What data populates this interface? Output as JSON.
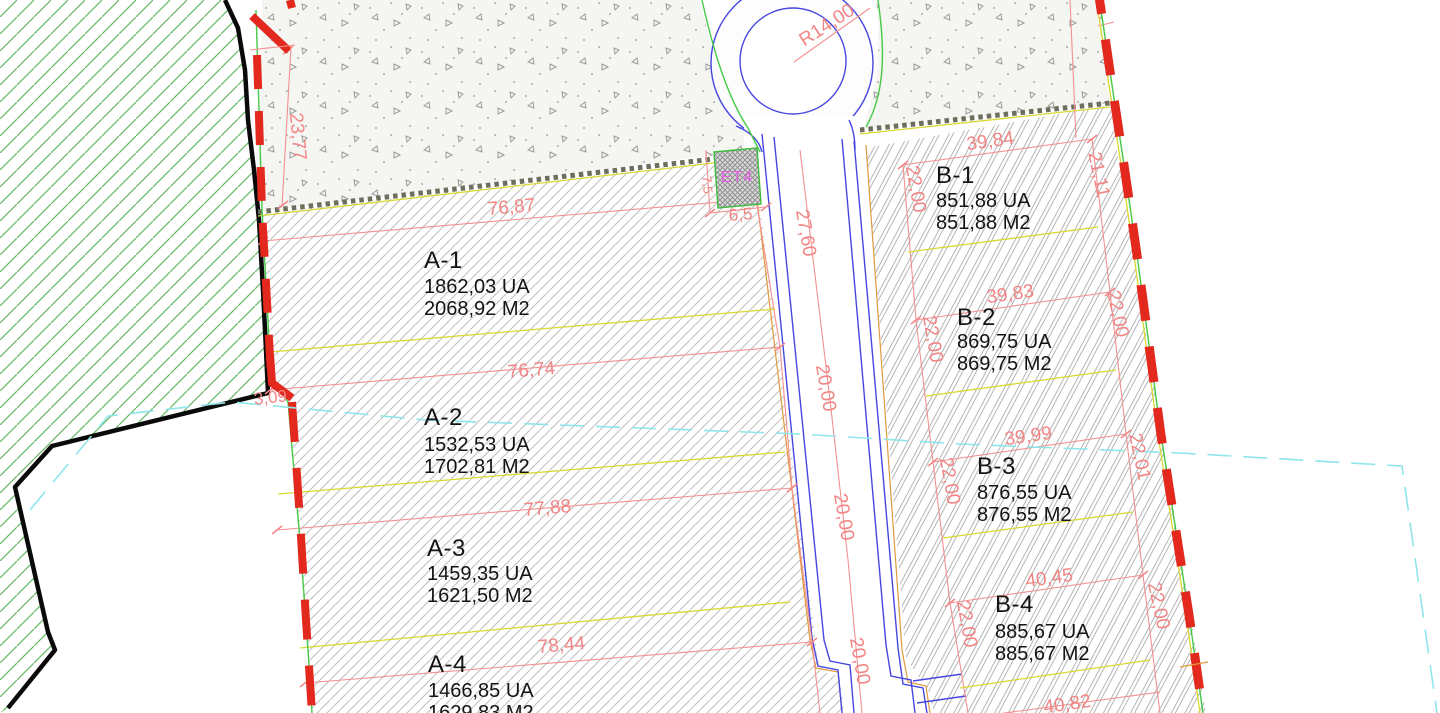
{
  "parcels": {
    "a": [
      {
        "name": "A-1",
        "area_ua": "1862,03 UA",
        "area_m2": "2068,92 M2"
      },
      {
        "name": "A-2",
        "area_ua": "1532,53 UA",
        "area_m2": "1702,81 M2"
      },
      {
        "name": "A-3",
        "area_ua": "1459,35 UA",
        "area_m2": "1621,50 M2"
      },
      {
        "name": "A-4",
        "area_ua": "1466,85 UA",
        "area_m2": "1629,83 M2"
      }
    ],
    "b": [
      {
        "name": "B-1",
        "area_ua": "851,88 UA",
        "area_m2": "851,88 M2"
      },
      {
        "name": "B-2",
        "area_ua": "869,75 UA",
        "area_m2": "869,75 M2"
      },
      {
        "name": "B-3",
        "area_ua": "876,55 UA",
        "area_m2": "876,55 M2"
      },
      {
        "name": "B-4",
        "area_ua": "885,67 UA",
        "area_m2": "885,67 M2"
      }
    ]
  },
  "dimensions": {
    "a_widths": [
      "76,87",
      "76,74",
      "77,88",
      "78,44"
    ],
    "b_widths": [
      "39,84",
      "39,83",
      "39,99",
      "40,45",
      "40,82"
    ],
    "b_left_depths": [
      "22,00",
      "22,00",
      "22,00",
      "22,00"
    ],
    "b_right_depths": [
      "21,11",
      "22,00",
      "22,01",
      "22,00"
    ],
    "road_radius": "R14,00",
    "road_width_top": "27,60",
    "road_segments": [
      "20,00",
      "20,00",
      "20,00"
    ],
    "left_boundary_length": "23,77",
    "left_boundary_offset": "3,09",
    "transformer_width": "6,5",
    "transformer_depth": "7,5"
  },
  "labels": {
    "transformer": "ET4"
  },
  "colors": {
    "dimension_red": "#f28585",
    "boundary_red": "#e3281e",
    "road_blue": "#4747e0",
    "utility_green": "#46c946",
    "utility_yellow": "#d8d832",
    "overlay_cyan": "#8fe6ea",
    "transformer_magenta": "#e65ce6",
    "hatch_gray": "#b9b9b9",
    "text_black": "#141414"
  }
}
